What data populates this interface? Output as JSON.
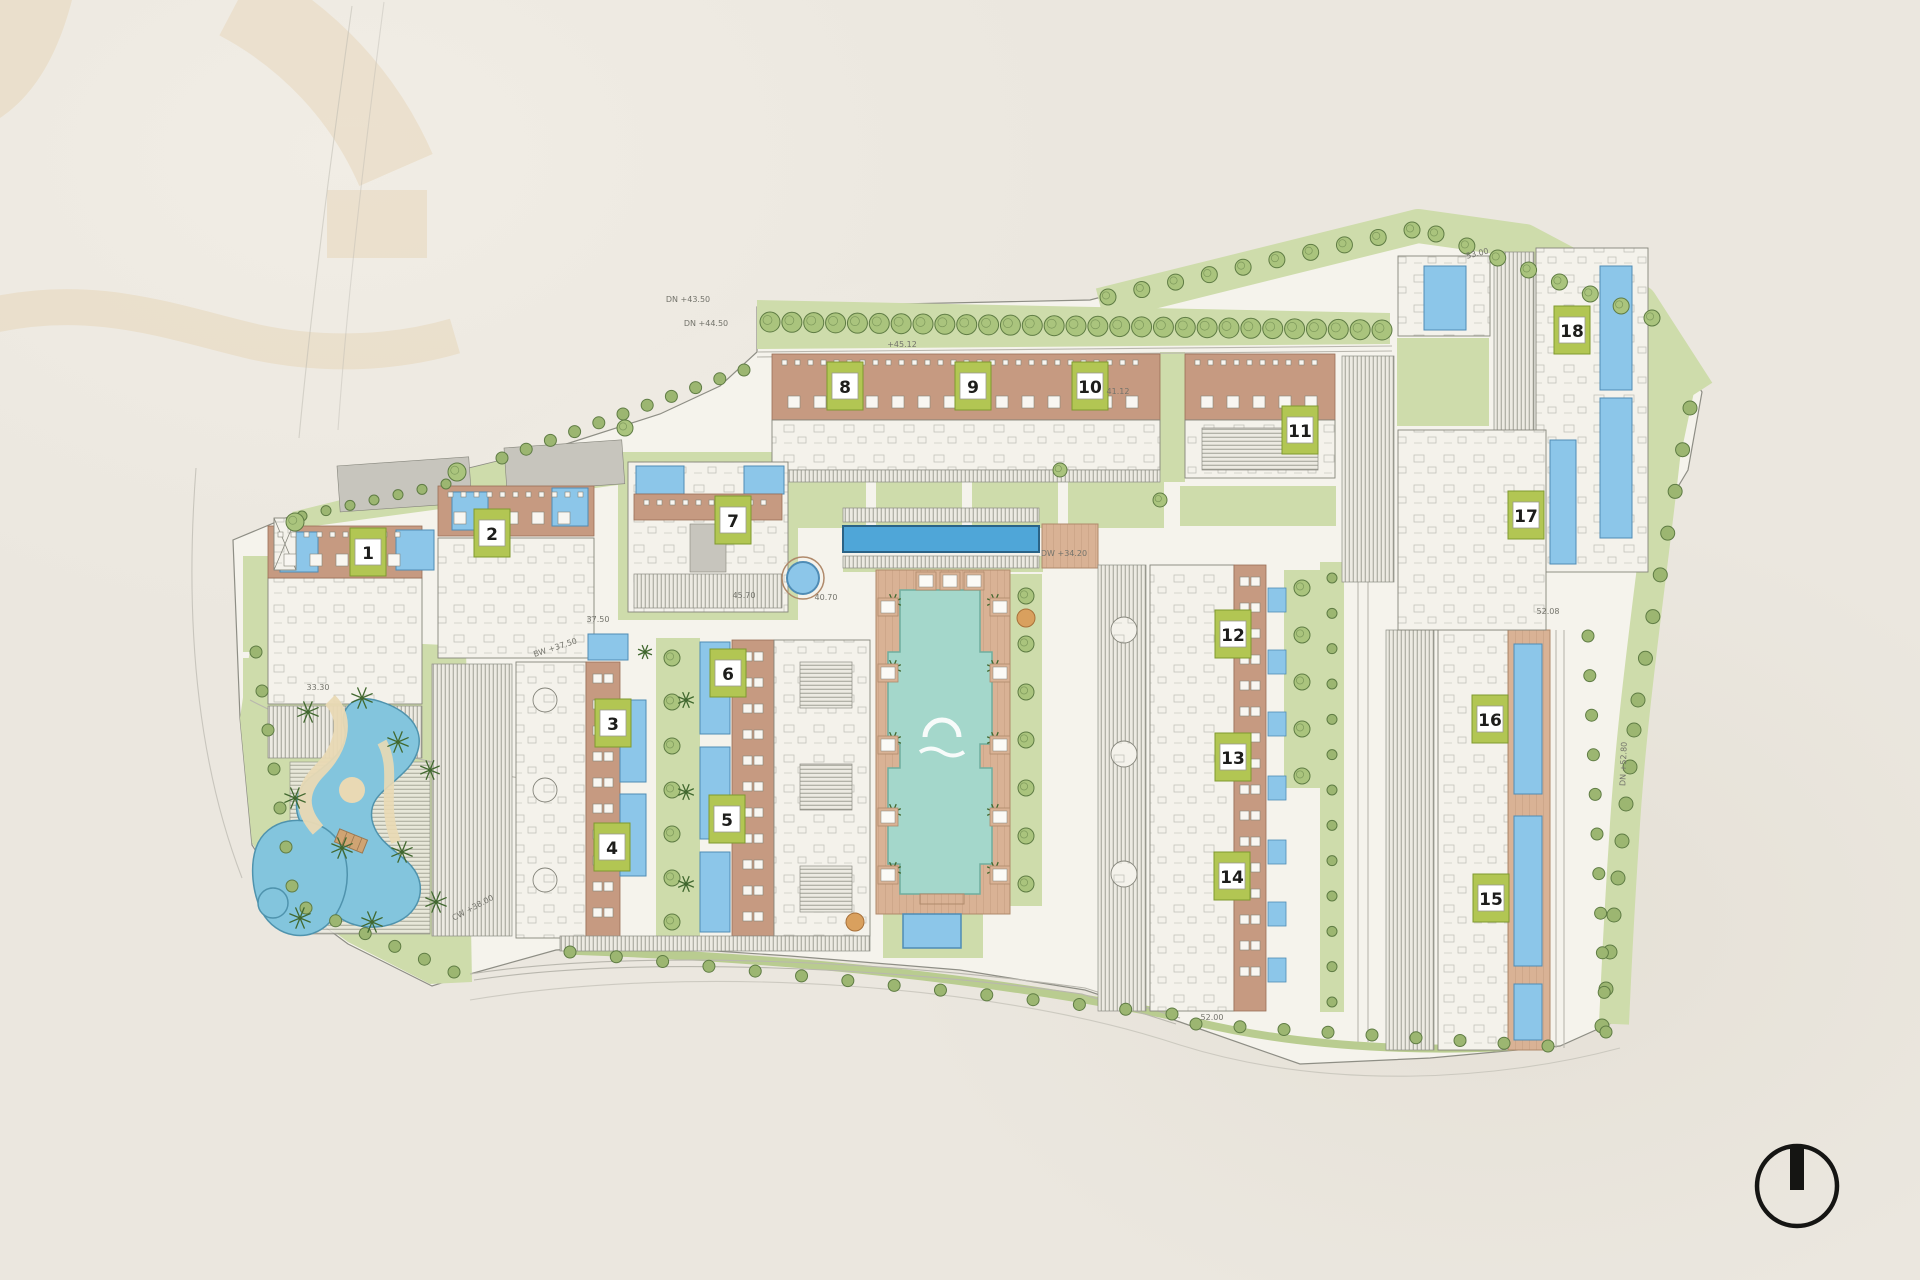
{
  "title": "Residential compound master plan",
  "palette": {
    "paper": "#ebe7df",
    "watermark": "#e8d9bf",
    "siteFill": "#f5f3ec",
    "siteLine": "#8e8e85",
    "lawn": "#cedcab",
    "lawnDark": "#b9cc90",
    "hedge": "#9cb671",
    "treeFill": "#aac47d",
    "treeLine": "#5f7c44",
    "palm": "#41682f",
    "palmTan": "#c49a5e",
    "terracotta": "#c69a81",
    "terracottaLine": "#9a6e55",
    "deck": "#d9b295",
    "deckLine": "#b08a6b",
    "unitFill": "#f4f2eb",
    "unitLine": "#85857b",
    "roofGray": "#c7c5bd",
    "hatchBg": "#eceae2",
    "hatchLine": "#8c8c81",
    "poolBlue": "#8cc6e9",
    "poolBlueDark": "#4f8cb5",
    "lapPool": "#4fa6d8",
    "lapPoolEdge": "#2b6386",
    "courtyardPool": "#a4d7cb",
    "courtyardPoolEdge": "#6fae9f",
    "lagoon": "#83c5dd",
    "lagoonEdge": "#4f93ad",
    "sand": "#e9d9b4",
    "plateGreen": "#b2c653",
    "plateBorder": "#7f992f",
    "plateBox": "#ffffff",
    "numberInk": "#1d1d1b",
    "roadLine": "#b9b7ae",
    "annotationInk": "#73736b",
    "compassInk": "#151513",
    "logoWhite": "#ffffff",
    "autumnFill": "#d9a05e",
    "autumnLine": "#a8713a",
    "bridge": "#cfa473",
    "bridgeLine": "#9a7750"
  },
  "watermark": {
    "opacity": 0.6
  },
  "buildings": [
    {
      "number": "1",
      "x": 368,
      "y": 552
    },
    {
      "number": "2",
      "x": 492,
      "y": 533
    },
    {
      "number": "3",
      "x": 613,
      "y": 723
    },
    {
      "number": "4",
      "x": 612,
      "y": 847
    },
    {
      "number": "5",
      "x": 727,
      "y": 819
    },
    {
      "number": "6",
      "x": 728,
      "y": 673
    },
    {
      "number": "7",
      "x": 733,
      "y": 520
    },
    {
      "number": "8",
      "x": 845,
      "y": 386
    },
    {
      "number": "9",
      "x": 973,
      "y": 386
    },
    {
      "number": "10",
      "x": 1090,
      "y": 386
    },
    {
      "number": "11",
      "x": 1300,
      "y": 430
    },
    {
      "number": "12",
      "x": 1233,
      "y": 634
    },
    {
      "number": "13",
      "x": 1233,
      "y": 757
    },
    {
      "number": "14",
      "x": 1232,
      "y": 876
    },
    {
      "number": "15",
      "x": 1491,
      "y": 898
    },
    {
      "number": "16",
      "x": 1490,
      "y": 719
    },
    {
      "number": "17",
      "x": 1526,
      "y": 515
    },
    {
      "number": "18",
      "x": 1572,
      "y": 330
    }
  ],
  "annotations": [
    {
      "text": "DN +43.50",
      "x": 688,
      "y": 302,
      "r": 0
    },
    {
      "text": "DN +44.50",
      "x": 706,
      "y": 326,
      "r": 0
    },
    {
      "text": "+45.12",
      "x": 902,
      "y": 347,
      "r": 0
    },
    {
      "text": "41.12",
      "x": 1118,
      "y": 394,
      "r": 0
    },
    {
      "text": "45.70",
      "x": 744,
      "y": 598,
      "r": 0
    },
    {
      "text": "40.70",
      "x": 826,
      "y": 600,
      "r": 0
    },
    {
      "text": "37.50",
      "x": 598,
      "y": 622,
      "r": 0
    },
    {
      "text": "BW +37.50",
      "x": 556,
      "y": 650,
      "r": -18
    },
    {
      "text": "DW +34.20",
      "x": 1064,
      "y": 556,
      "r": 0
    },
    {
      "text": "52.08",
      "x": 1548,
      "y": 614,
      "r": 0
    },
    {
      "text": "53.00",
      "x": 1478,
      "y": 256,
      "r": -14
    },
    {
      "text": "33.30",
      "x": 318,
      "y": 690,
      "r": 0
    },
    {
      "text": "CW +38.00",
      "x": 474,
      "y": 910,
      "r": -28
    },
    {
      "text": "DN +52.80",
      "x": 1626,
      "y": 764,
      "r": -88
    },
    {
      "text": "52.00",
      "x": 1212,
      "y": 1020,
      "r": 0
    }
  ],
  "compass": {
    "cx": 1797,
    "cy": 1186,
    "r": 40
  }
}
